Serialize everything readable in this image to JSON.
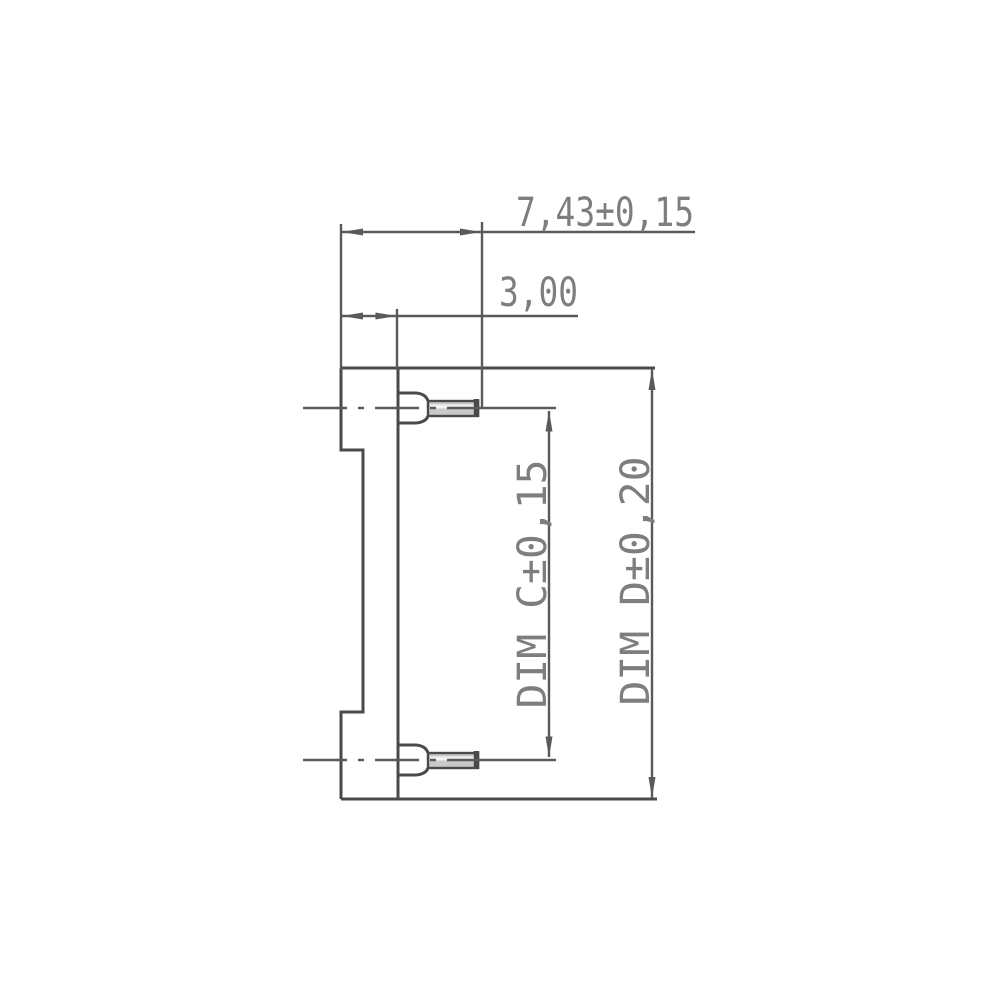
{
  "drawing": {
    "type": "technical-dimension-drawing",
    "subject": "IC socket side view with pin dimensions",
    "labels": {
      "top_width": "7,43±0,15",
      "pin_offset": "3,00",
      "dim_c": "DIM C±0,15",
      "dim_d": "DIM D±0,20"
    }
  },
  "colors": {
    "line": "#4a4a4a",
    "dim_line": "#5a5a5a",
    "text": "#7e7e7e",
    "pin_fill": "#c9c9c9",
    "pin_stripe": "#f2f2f2",
    "background": "#ffffff"
  }
}
